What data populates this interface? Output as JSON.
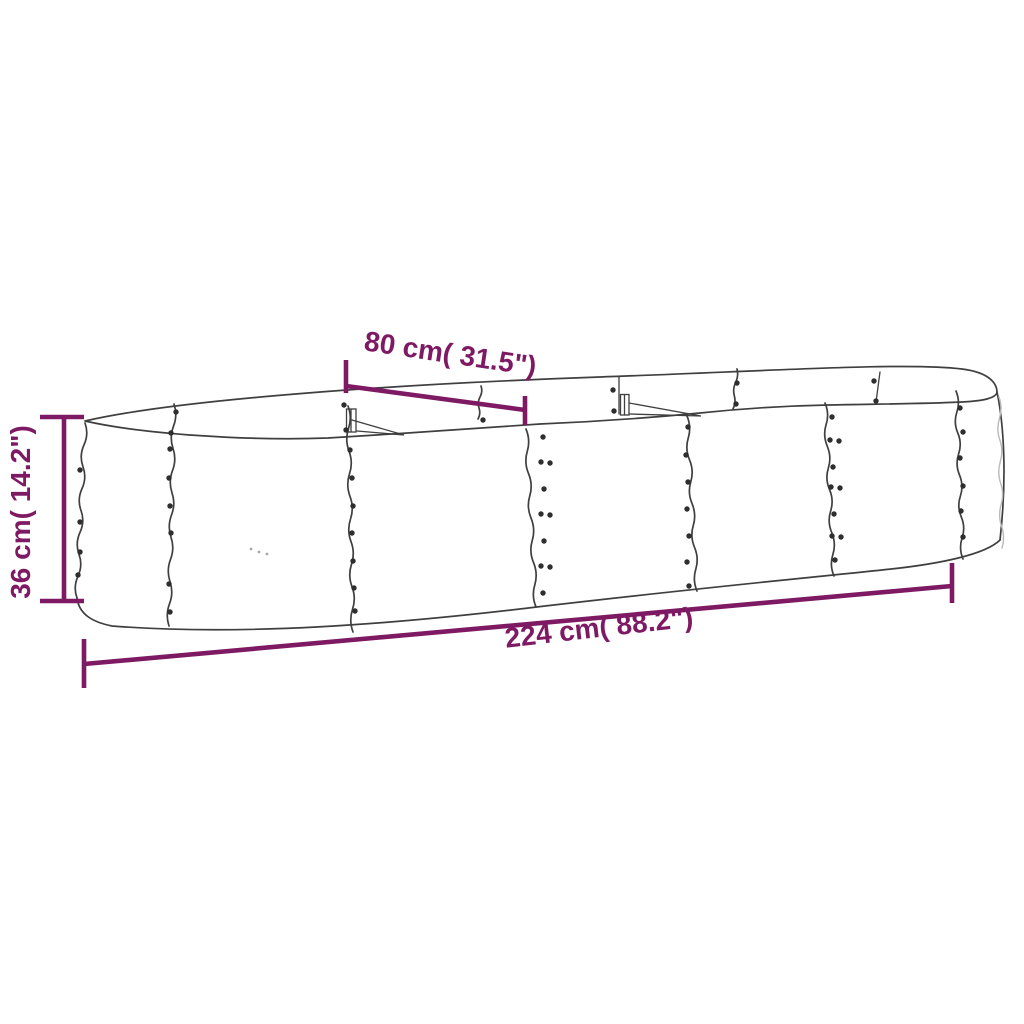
{
  "page": {
    "background": "#ffffff"
  },
  "diagram": {
    "title": "Oval raised garden bed — corrugated steel planter dimension drawing",
    "accent_color": "#7e1a63",
    "line_color": "#3f3f3f",
    "dimensions": [
      {
        "id": "width",
        "label": "80 cm( 31.5\")",
        "value_cm": 80,
        "value_in": 31.5
      },
      {
        "id": "height",
        "label": "36 cm( 14.2\")",
        "value_cm": 36,
        "value_in": 14.2
      },
      {
        "id": "length",
        "label": "224 cm( 88.2\")",
        "value_cm": 224,
        "value_in": 88.2
      }
    ]
  }
}
